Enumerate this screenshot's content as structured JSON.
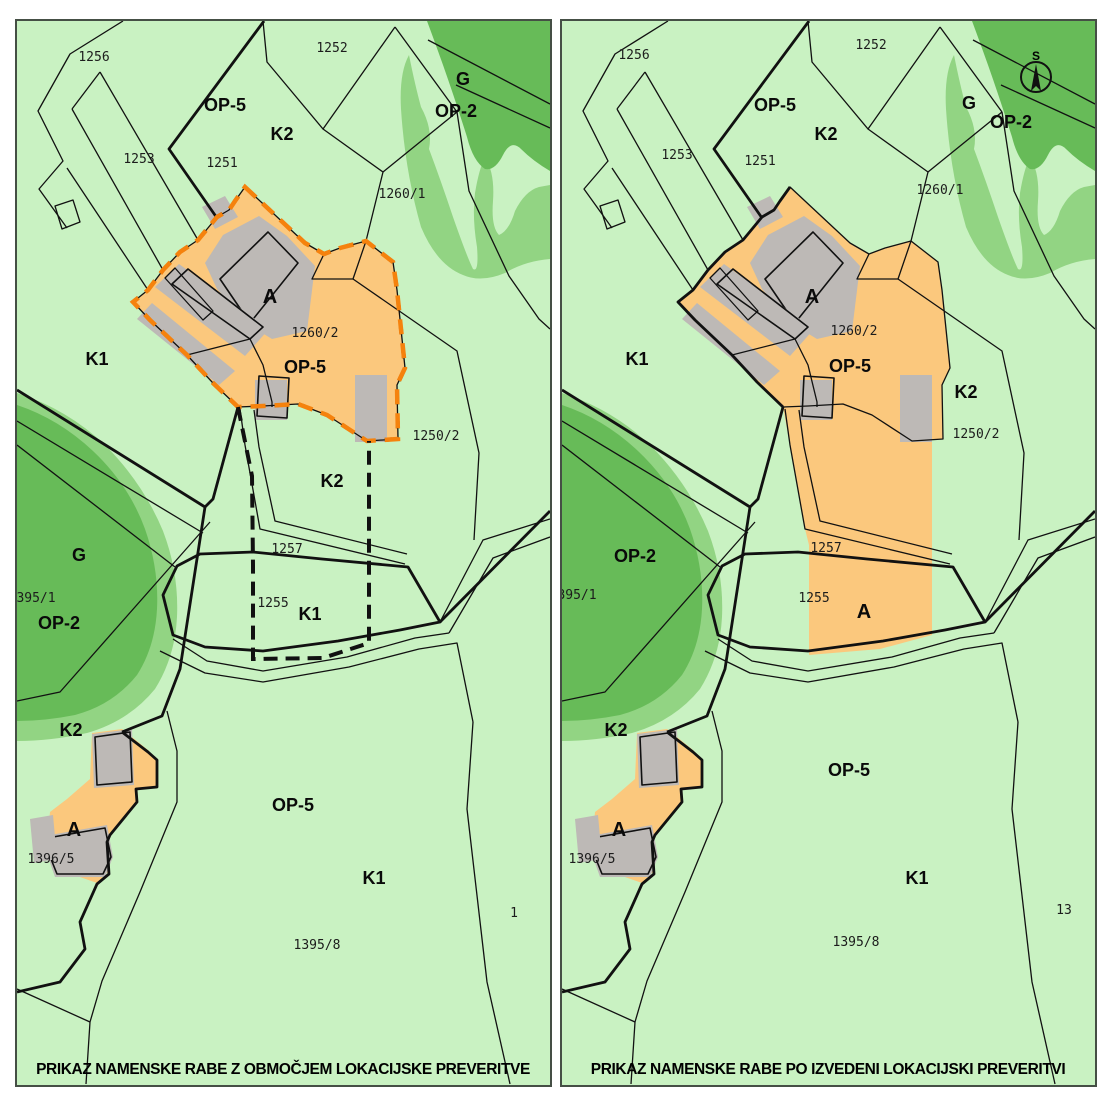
{
  "figure": {
    "kind": "land-use comparison map, lokacijska preveritev"
  },
  "colors": {
    "background": "#ffffff",
    "map_green_light": "#c9f2c2",
    "map_green_medium": "#92d483",
    "map_green_dark": "#67bb58",
    "urban_orange": "#fbc87d",
    "boundary_orange": "#f5820d",
    "building_gray": "#bdb9b6",
    "line_black": "#111111",
    "panel_border": "#454f45"
  },
  "left": {
    "title": "PRIKAZ NAMENSKE RABE Z OBMOČJEM LOKACIJSKE PREVERITVE",
    "zones": {
      "op5_top": "OP-5",
      "k2_top": "K2",
      "g_ne": "G",
      "op2_ne": "OP-2",
      "k1_w": "K1",
      "a_main": "A",
      "op5_main": "OP-5",
      "g_w": "G",
      "op2_w": "OP-2",
      "k2_mid": "K2",
      "k1_oval": "K1",
      "k2_sw": "K2",
      "a_sw": "A",
      "op5_s": "OP-5",
      "k1_s": "K1"
    },
    "parcels": {
      "p1256": "1256",
      "p1252": "1252",
      "p1253": "1253",
      "p1251": "1251",
      "p1260_1": "1260/1",
      "p1260_2": "1260/2",
      "p1250_2": "1250/2",
      "p1257": "1257",
      "p1255": "1255",
      "p395_1": "395/1",
      "p1396_5": "1396/5",
      "p1395_8": "1395/8",
      "edge": "1"
    }
  },
  "right": {
    "title": "PRIKAZ NAMENSKE RABE PO IZVEDENI LOKACIJSKI PREVERITVI",
    "compass": {
      "north": "S"
    },
    "zones": {
      "op5_top": "OP-5",
      "k2_top": "K2",
      "g_ne": "G",
      "op2_ne": "OP-2",
      "k1_w": "K1",
      "a_main": "A",
      "op5_main": "OP-5",
      "op2_w": "OP-2",
      "k2_ne2": "K2",
      "a_oval": "A",
      "k2_sw": "K2",
      "a_sw": "A",
      "op5_s": "OP-5",
      "k1_s": "K1"
    },
    "parcels": {
      "p1256": "1256",
      "p1252": "1252",
      "p1253": "1253",
      "p1251": "1251",
      "p1260_1": "1260/1",
      "p1260_2": "1260/2",
      "p1250_2": "1250/2",
      "p1257": "1257",
      "p1255": "1255",
      "p395_1": "395/1",
      "p1396_5": "1396/5",
      "p1395_8": "1395/8",
      "edge": "13"
    }
  }
}
